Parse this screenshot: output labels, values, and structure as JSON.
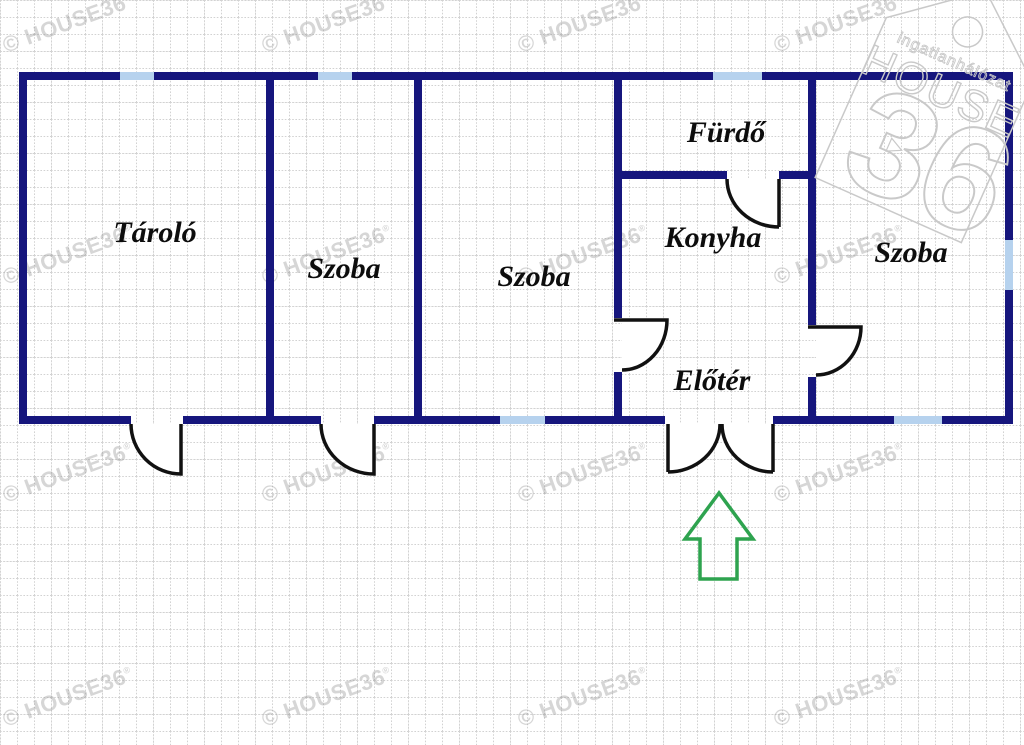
{
  "rooms": [
    {
      "id": "tarolo",
      "label": "Tároló"
    },
    {
      "id": "szoba-1",
      "label": "Szoba"
    },
    {
      "id": "szoba-2",
      "label": "Szoba"
    },
    {
      "id": "furdo",
      "label": "Fürdő"
    },
    {
      "id": "konyha",
      "label": "Konyha"
    },
    {
      "id": "eloter",
      "label": "Előtér"
    },
    {
      "id": "szoba-3",
      "label": "Szoba"
    }
  ],
  "watermark": {
    "text": "© HOUSE36",
    "reg": "®"
  },
  "logo": {
    "network": "ingatlanhálózat",
    "brand": "HOUSE",
    "number": "36"
  },
  "entrance": {
    "direction": "up"
  },
  "colors": {
    "wall": "#16167d",
    "window": "#b6d2ee",
    "door": "#111111",
    "arrow": "#2ea34f",
    "label": "#0d0d0d",
    "watermark": "#9a9a9a",
    "grid": "#d2d2d2",
    "logoline": "#c9c9c9"
  }
}
